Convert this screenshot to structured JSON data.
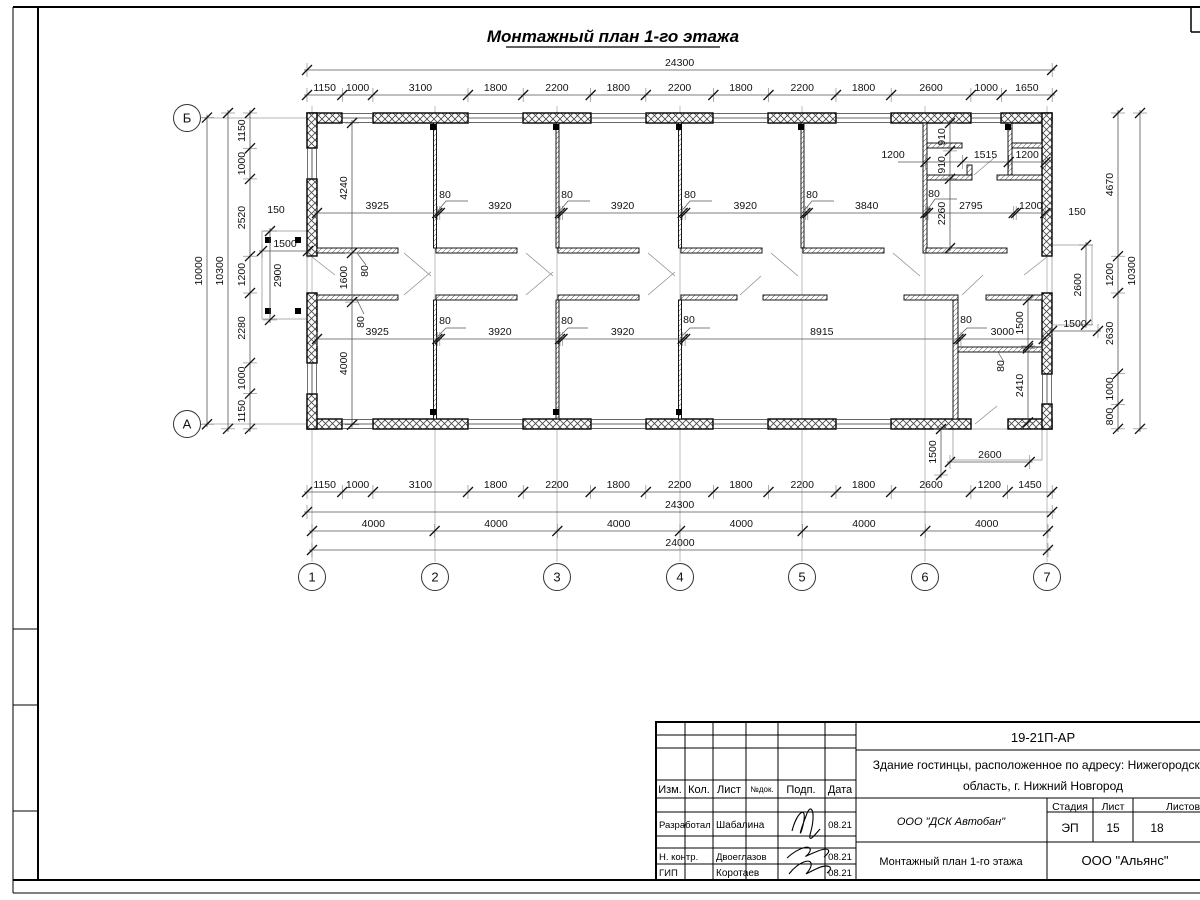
{
  "title": "Монтажный план 1-го этажа",
  "axes": {
    "cols": [
      {
        "label": "1",
        "x": 312
      },
      {
        "label": "2",
        "x": 435
      },
      {
        "label": "3",
        "x": 557
      },
      {
        "label": "4",
        "x": 680
      },
      {
        "label": "5",
        "x": 802
      },
      {
        "label": "6",
        "x": 925
      },
      {
        "label": "7",
        "x": 1047
      }
    ],
    "rows": [
      {
        "label": "Б",
        "y": 118
      },
      {
        "label": "А",
        "y": 424
      }
    ]
  },
  "dims": {
    "chains": [
      {
        "o": "h",
        "pos": 70,
        "start": 307,
        "mm": [
          24300
        ]
      },
      {
        "o": "h",
        "pos": 95,
        "start": 307,
        "mm": [
          1150,
          1000,
          3100,
          1800,
          2200,
          1800,
          2200,
          1800,
          2200,
          1800,
          2600,
          1000,
          1650
        ]
      },
      {
        "o": "h",
        "pos": 492,
        "start": 307,
        "mm": [
          1150,
          1000,
          3100,
          1800,
          2200,
          1800,
          2200,
          1800,
          2200,
          1800,
          2600,
          1200,
          1450
        ]
      },
      {
        "o": "h",
        "pos": 512,
        "start": 307,
        "mm": [
          24300
        ]
      },
      {
        "o": "h",
        "pos": 531,
        "start": 312,
        "mm": [
          4000,
          4000,
          4000,
          4000,
          4000,
          4000
        ]
      },
      {
        "o": "h",
        "pos": 550,
        "start": 312,
        "mm": [
          24000
        ]
      },
      {
        "o": "h",
        "pos": 213,
        "start": 317,
        "mm": [
          3925,
          80,
          3920,
          80,
          3920,
          80,
          3920,
          80,
          3840,
          80,
          2795,
          80,
          950
        ],
        "labels": [
          "3925",
          null,
          "3920",
          null,
          "3920",
          null,
          "3920",
          null,
          "3840",
          null,
          "2795",
          null,
          "1200"
        ]
      },
      {
        "o": "h",
        "pos": 339,
        "start": 317,
        "mm": [
          3925,
          80,
          3920,
          80,
          3920,
          80,
          8915,
          80,
          2700
        ],
        "labels": [
          "3925",
          null,
          "3920",
          null,
          "3920",
          null,
          "8915",
          null,
          "3000"
        ]
      },
      {
        "o": "h",
        "pos": 162,
        "start": 925.5,
        "mm": [
          1200,
          1515,
          1200
        ],
        "labels": [
          null,
          "1515",
          "1200"
        ]
      },
      {
        "o": "v",
        "pos": 950,
        "start": 123,
        "mm": [
          910,
          910,
          2260
        ]
      },
      {
        "o": "v",
        "pos": 352,
        "start": 123,
        "mm": [
          4240,
          1600,
          4000
        ]
      },
      {
        "o": "v",
        "pos": 250,
        "start": 113,
        "mm": [
          1150,
          1000,
          2520,
          1200,
          2280,
          1000,
          1150
        ]
      },
      {
        "o": "v",
        "pos": 228,
        "start": 113,
        "mm": [
          10300
        ]
      },
      {
        "o": "v",
        "pos": 207,
        "start": 117.6,
        "mm": [
          10000
        ]
      },
      {
        "o": "v",
        "pos": 1118,
        "start": 113,
        "mm": [
          4670,
          1200,
          2630,
          1000,
          800
        ]
      },
      {
        "o": "v",
        "pos": 1140,
        "start": 113,
        "mm": [
          10300
        ]
      },
      {
        "o": "h",
        "pos": 251,
        "start": 262,
        "mm": [
          1500
        ]
      },
      {
        "o": "v",
        "pos": 270,
        "start": 231,
        "mm": [
          2900
        ],
        "side": 1
      },
      {
        "o": "v",
        "pos": 1086,
        "start": 245,
        "mm": [
          2600
        ]
      },
      {
        "o": "h",
        "pos": 331,
        "start": 1052,
        "mm": [
          1500
        ]
      },
      {
        "o": "v",
        "pos": 941,
        "start": 429,
        "mm": [
          1500
        ]
      },
      {
        "o": "h",
        "pos": 462,
        "start": 950,
        "mm": [
          2600
        ]
      },
      {
        "o": "v",
        "pos": 1028,
        "start": 300,
        "mm": [
          1500,
          80,
          2410
        ],
        "labels": [
          "1500",
          null,
          "2410"
        ]
      }
    ],
    "labels": [
      {
        "t": "80",
        "x": 445,
        "y": 198
      },
      {
        "t": "80",
        "x": 567,
        "y": 198
      },
      {
        "t": "80",
        "x": 690,
        "y": 198
      },
      {
        "t": "80",
        "x": 812,
        "y": 198
      },
      {
        "t": "80",
        "x": 934,
        "y": 197
      },
      {
        "t": "1200",
        "x": 893,
        "y": 158
      },
      {
        "t": "150",
        "x": 1077,
        "y": 215
      },
      {
        "t": "80",
        "x": 368,
        "y": 271,
        "r": -90
      },
      {
        "t": "150",
        "x": 276,
        "y": 213
      },
      {
        "t": "80",
        "x": 364,
        "y": 322,
        "r": -90
      },
      {
        "t": "80",
        "x": 445,
        "y": 324
      },
      {
        "t": "80",
        "x": 567,
        "y": 324
      },
      {
        "t": "80",
        "x": 689,
        "y": 323
      },
      {
        "t": "80",
        "x": 966,
        "y": 323
      },
      {
        "t": "80",
        "x": 1004,
        "y": 366,
        "r": -90
      }
    ]
  },
  "stamp": {
    "code": "19-21П-АР",
    "object_line1": "Здание гостинцы, расположенное по адресу: Нижегородская",
    "object_line2": "область, г. Нижний Новгород",
    "header": {
      "izm": "Изм.",
      "kol": "Кол.",
      "list": "Лист",
      "ndok": "№док.",
      "podp": "Подп.",
      "data": "Дата"
    },
    "rows": [
      {
        "role": "Разработал",
        "name": "Шабалина",
        "date": "08.21"
      },
      {
        "role": "Н. контр.",
        "name": "Двоеглазов",
        "date": "08.21"
      },
      {
        "role": "ГИП",
        "name": "Коротаев",
        "date": "08.21"
      }
    ],
    "stage_label": "Стадия",
    "sheet_label": "Лист",
    "sheets_label": "Листов",
    "stage": "ЭП",
    "sheet": "15",
    "sheets": "18",
    "org1": "ООО \"ДСК Автобан\"",
    "drawing_name": "Монтажный план 1-го этажа",
    "org2": "ООО \"Альянс\""
  }
}
